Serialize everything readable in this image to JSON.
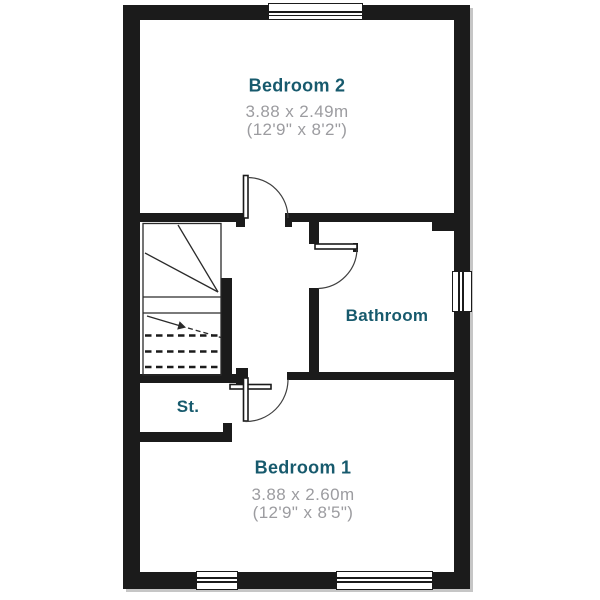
{
  "plan": {
    "rooms": [
      {
        "id": "bedroom2",
        "name": "Bedroom 2",
        "dim_metric": "3.88 x 2.49m",
        "dim_imperial": "(12'9\" x 8'2\")"
      },
      {
        "id": "bathroom",
        "name": "Bathroom"
      },
      {
        "id": "storage",
        "name": "St."
      },
      {
        "id": "bedroom1",
        "name": "Bedroom 1",
        "dim_metric": "3.88 x 2.60m",
        "dim_imperial": "(12'9\" x 8'5\")"
      }
    ],
    "features": {
      "stairs": "half-turn staircase with winders, up-arrow and dashed treads",
      "windows": 4,
      "doors": 4
    }
  },
  "theme": {
    "wall_color": "#1b1b1b",
    "line_color": "#2a2a2a",
    "room_label_color": "#175a6d",
    "dimension_color": "#9c9ca0",
    "background": "#ffffff"
  }
}
